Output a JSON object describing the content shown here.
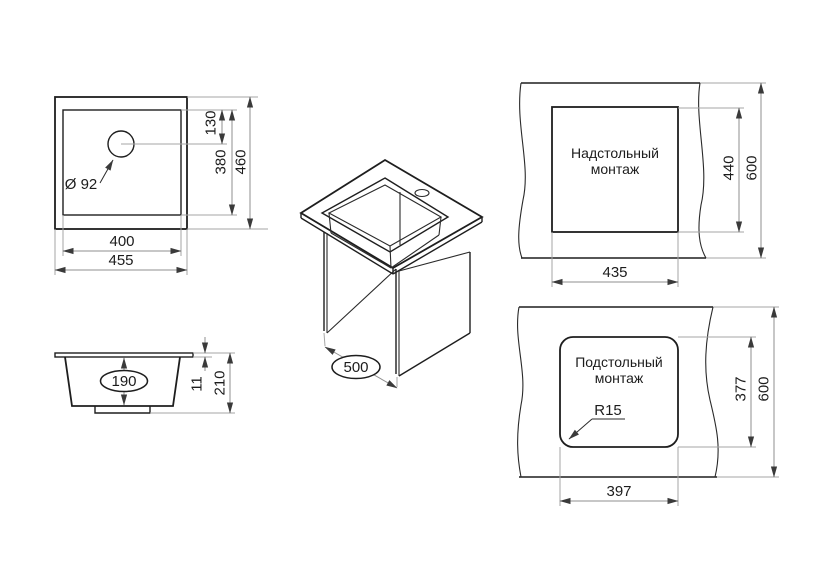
{
  "colors": {
    "object_line": "#1e1e1e",
    "dimension_line": "#8f8f8f",
    "text": "#1c1c1c",
    "background": "#ffffff"
  },
  "views": {
    "top_view": {
      "hole_label": "Ø 92",
      "dim_hole_offset": "130",
      "dim_inner_height": "380",
      "dim_outer_height": "460",
      "dim_inner_width": "400",
      "dim_outer_width": "455"
    },
    "side_view": {
      "dim_bowl_depth": "190",
      "dim_rim_height": "11",
      "dim_total_height": "210"
    },
    "iso_view": {
      "dim_depth": "500"
    },
    "top_mount": {
      "title_line1": "Надстольный",
      "title_line2": "монтаж",
      "dim_cutout_width": "435",
      "dim_cutout_height": "440",
      "dim_counter_height": "600"
    },
    "under_mount": {
      "title_line1": "Подстольный",
      "title_line2": "монтаж",
      "corner_radius": "R15",
      "dim_cutout_width": "397",
      "dim_cutout_height": "377",
      "dim_counter_height": "600"
    }
  }
}
